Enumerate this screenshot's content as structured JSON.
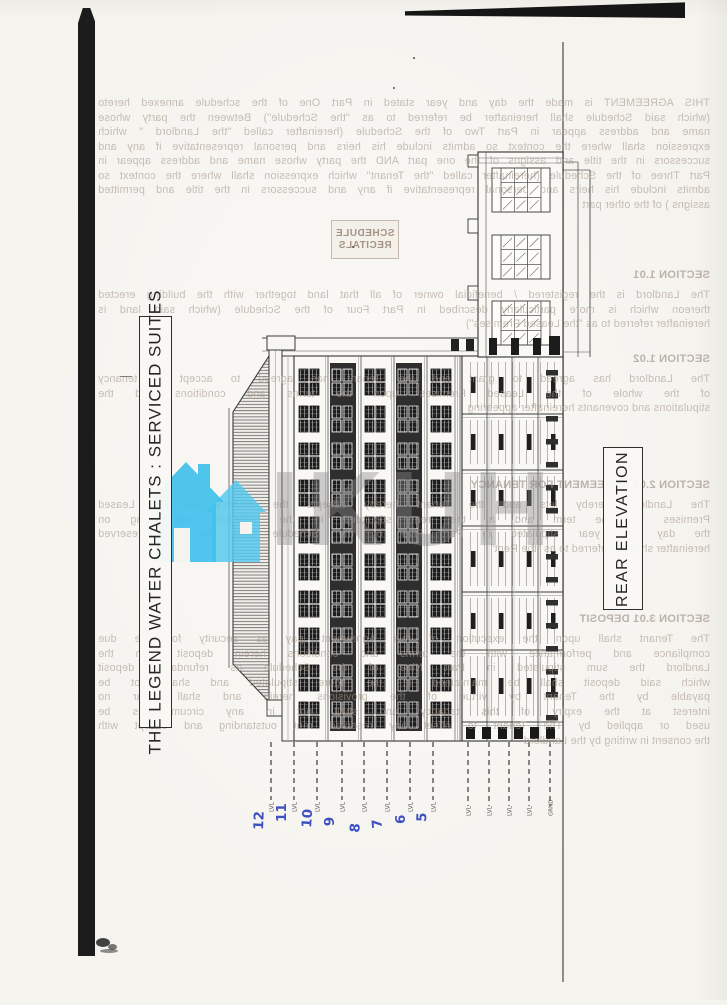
{
  "page": {
    "kind": "scanned architectural drawing sheet, rotated 90 degrees in scan",
    "paper_color": "#f5f3ee"
  },
  "title_box": {
    "text": "THE LEGEND WATER CHALETS : SERVICED SUITES"
  },
  "elevation_label_box": {
    "text": "REAR ELEVATION"
  },
  "level_markers": {
    "handwritten_color": "#3f51c1",
    "handwritten": [
      "12",
      "11",
      "10",
      "9",
      "8",
      "7",
      "6",
      "5"
    ],
    "printed_left": [
      "LVL",
      "LVL",
      "LVL",
      "LVL",
      "LVL",
      "LVL",
      "LVL",
      "LVL"
    ],
    "printed_right": [
      "LVL",
      "LVL",
      "LVL",
      "LVL",
      "GRND"
    ]
  },
  "watermark": {
    "logo": "twin-house-icon",
    "logo_color": "#3ec0ec",
    "letters": "IKUH",
    "letters_color": "#8a8a8a"
  },
  "stamp_box": {
    "lines": [
      "SCHEDULE",
      "RECITALS"
    ]
  },
  "showthrough": {
    "note": "mirrored show-through text from reverse side of page",
    "color": "#a89a8e",
    "blocks": [
      {
        "top": 96,
        "lines": [
          "THIS AGREEMENT is made the day and year stated in Part One of the schedule annexed hereto",
          "(which said Schedule shall hereinafter be referred to as \"the Schedule\") Between the party whose",
          "name and address appear in Part Two of the Schedule (hereinafter called \"the Landlord \" which",
          "expression shall where the context so admits include his heirs and personal representative if any and",
          "successors in the title and assigns of the one part AND the party whose name and address appear in",
          "Part Three of the Schedule (hereinafter called \"the Tenant\" which expression shall where the context so",
          "admits include his heirs and personal representative if any and successors in the title and permitted",
          "assigns ) of the other part"
        ]
      },
      {
        "top": 268,
        "header": "SECTION 1.01"
      },
      {
        "top": 288,
        "lines": [
          "The Landlord is the registered / beneficial owner of all that land together with the building erected",
          "thereon which is more particularly described in Part Four of the Schedule (which said land is",
          "hereinafter referred to as \"the Leased Premises\")"
        ]
      },
      {
        "top": 352,
        "header": "SECTION 1.02"
      },
      {
        "top": 372,
        "lines": [
          "The Landlord has agreed to grant and the Tenant has agreed to accept a tenancy",
          "of the whole of the Leased Premises upon the terms and conditions and the",
          "stipulations and covenants hereinafter appearing"
        ]
      },
      {
        "top": 478,
        "header": "SECTION 2.01   AGREEMENT FOR TENANCY"
      },
      {
        "top": 498,
        "lines": [
          "The Landlord hereby lets and the Tenant hereby accepts the tenancy of the Leased",
          "Premises for the term and at the rent stipulated in the Schedule commencing on",
          "the day and year stipulated in Part Five of the Schedule and the rent reserved",
          "hereinafter shall be referred to as \"the Rent\""
        ]
      },
      {
        "top": 612,
        "header": "SECTION 3.01   DEPOSIT"
      },
      {
        "top": 632,
        "lines": [
          "The Tenant shall upon the execution of this Agreement pay as security for the due",
          "compliance and performance with the terms and conditions herein deposit with the",
          "Landlord the sum stipulated in Part Nine of the Schedule as refundable deposit",
          "which said deposit shall be maintained at the figure stipulated and shall not be",
          "payable by the Tenant by virtue of the provisions herein and shall bear no",
          "interest at the expiry of this tenancy and shall not in any circumstances be",
          "used or applied by The Tenant to offset any reserved rent outstanding and except with",
          "the consent in writing by the Landlord"
        ]
      }
    ]
  }
}
